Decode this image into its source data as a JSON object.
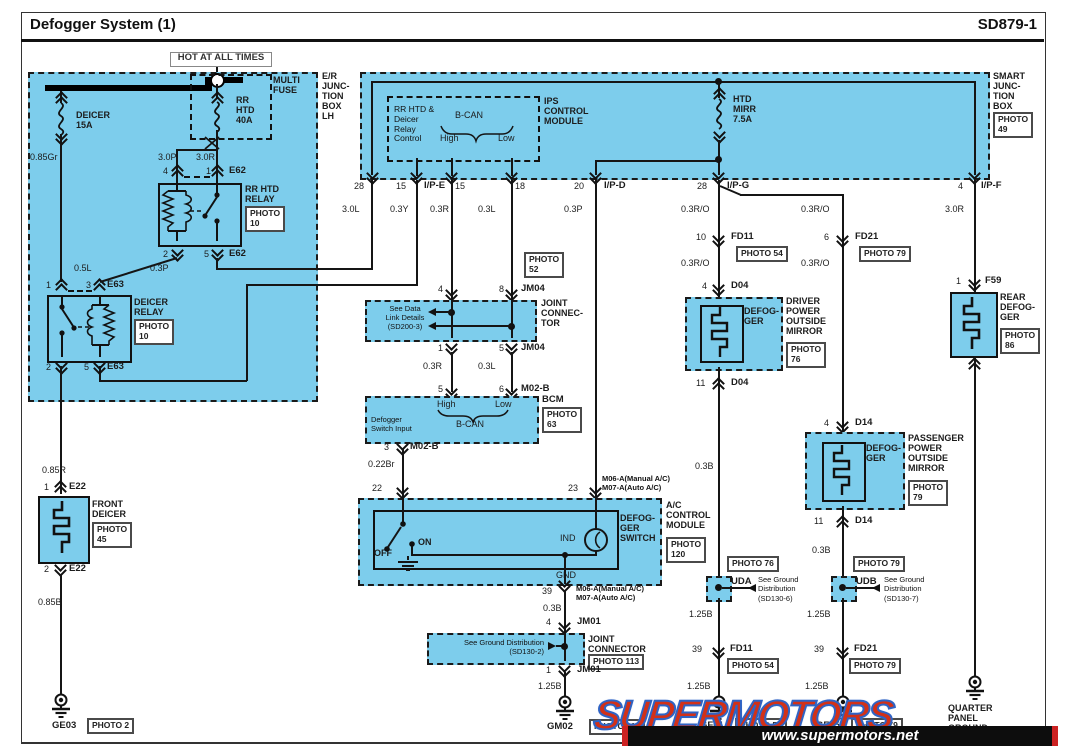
{
  "header": {
    "title": "Defogger System (1)",
    "code": "SD879-1",
    "hot": "HOT AT ALL TIMES"
  },
  "boxes": {
    "er": "E/R\nJUNC-\nTION\nBOX\nLH",
    "multifuse": "MULTI\nFUSE",
    "sjb": "SMART\nJUNC-\nTION\nBOX",
    "ips": "IPS\nCONTROL\nMODULE",
    "ips_ctrl": "RR HTD &\nDeicer\nRelay\nControl",
    "bcan": "B-CAN",
    "high": "High",
    "low": "Low",
    "bcm": "BCM",
    "bcm_input": "Defogger\nSwitch Input",
    "joint3": "JOINT\nCONNEC-\nTOR",
    "joint2": "JOINT\nCONNECTOR",
    "see_data": "See Data\nLink Details\n(SD200-3)",
    "see_gnd2": "See Ground Distribution\n(SD130-2)",
    "see_gnd6": "See Ground\nDistribution\n(SD130-6)",
    "see_gnd7": "See Ground\nDistribution\n(SD130-7)",
    "rr_relay": "RR HTD\nRELAY",
    "deicer_relay": "DEICER\nRELAY",
    "front_deicer": "FRONT\nDEICER",
    "defogger2": "DEFOG-\nGER",
    "driver": "DRIVER\nPOWER\nOUTSIDE\nMIRROR",
    "passenger": "PASSENGER\nPOWER\nOUTSIDE\nMIRROR",
    "rear": "REAR\nDEFOG-\nGER",
    "switch": "DEFOG-\nGER\nSWITCH",
    "acm": "A/C\nCONTROL\nMODULE",
    "quarter": "QUARTER\nPANEL\nGROUND",
    "off": "OFF",
    "on": "ON",
    "ind": "IND",
    "gnd": "GND",
    "m0607": "M06-A(Manual A/C)\nM07-A(Auto A/C)"
  },
  "fuses": {
    "deicer": "DEICER\n15A",
    "rr": "RR\nHTD\n40A",
    "htd_mirr": "HTD\nMIRR\n7.5A"
  },
  "wires": {
    "g085gr": "0.85Gr",
    "g30p": "3.0P",
    "g30r": "3.0R",
    "g30l": "3.0L",
    "g03y": "0.3Y",
    "g03r": "0.3R",
    "g03l": "0.3L",
    "g03p": "0.3P",
    "g03ro": "0.3R/O",
    "g05l": "0.5L",
    "g085r": "0.85R",
    "g085b": "0.85B",
    "g022br": "0.22Br",
    "g03b": "0.3B",
    "g125b": "1.25B"
  },
  "conn": {
    "e62": "E62",
    "e63": "E63",
    "e22": "E22",
    "jm04": "JM04",
    "m02b": "M02-B",
    "jm01": "JM01",
    "f59": "F59",
    "d04": "D04",
    "d14": "D14",
    "fd11": "FD11",
    "fd21": "FD21",
    "ipe": "I/P-E",
    "ipd": "I/P-D",
    "ipg": "I/P-G",
    "ipf": "I/P-F",
    "uda": "UDA",
    "udb": "UDB",
    "ge03": "GE03",
    "gm02": "GM02",
    "gf01": "GF01",
    "gf05": "GF05"
  },
  "n": {
    "1": "1",
    "2": "2",
    "3": "3",
    "4": "4",
    "5": "5",
    "6": "6",
    "8": "8",
    "10": "10",
    "11": "11",
    "15": "15",
    "18": "18",
    "20": "20",
    "22": "22",
    "23": "23",
    "28": "28",
    "39": "39"
  },
  "photos": {
    "p2": "PHOTO 2",
    "p10": "PHOTO\n10",
    "p45": "PHOTO\n45",
    "p49": "PHOTO\n49",
    "p52": "PHOTO\n52",
    "p54": "PHOTO 54",
    "p63": "PHOTO\n63",
    "p76": "PHOTO\n76",
    "p76s": "PHOTO 76",
    "p79": "PHOTO\n79",
    "p79s": "PHOTO 79",
    "p86": "PHOTO\n86",
    "p112": "PHOTO 112",
    "p113": "PHOTO 113",
    "p120": "PHOTO\n120"
  },
  "watermark": {
    "logo": "SUPERMOTORS",
    "url": "www.supermotors.net"
  }
}
